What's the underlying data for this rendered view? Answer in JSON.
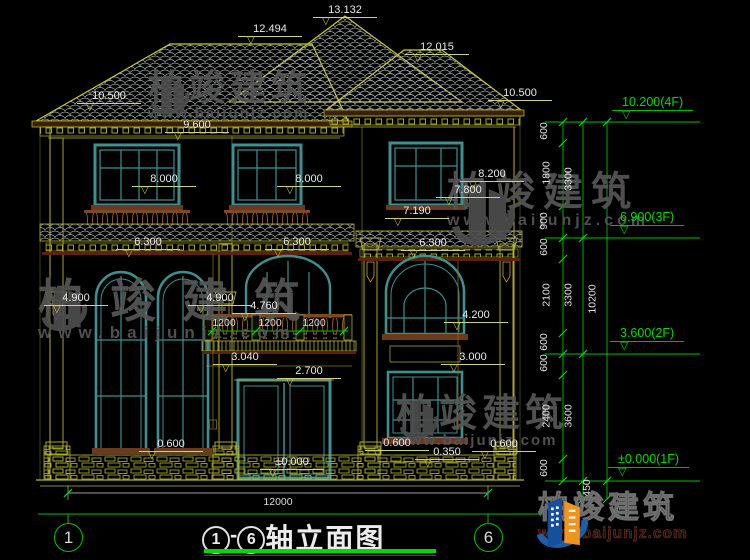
{
  "watermark": {
    "name": "柏竣建筑",
    "url": "www.baijunjz.com"
  },
  "logo": {
    "name": "柏竣建筑",
    "url": "www.baijunjz.com"
  },
  "title": {
    "axis_start": "1",
    "separator": "-",
    "axis_end": "6",
    "text": "轴立面图"
  },
  "axis_bubbles": {
    "left": "1",
    "right": "6"
  },
  "levels": [
    {
      "label": "10.200(4F)",
      "x": 612,
      "y": 96
    },
    {
      "label": "6.900(3F)",
      "x": 610,
      "y": 211
    },
    {
      "label": "3.600(2F)",
      "x": 610,
      "y": 327
    },
    {
      "label": "±0.000(1F)",
      "x": 608,
      "y": 453
    }
  ],
  "dims": [
    {
      "t": "13.132",
      "x": 345,
      "y": 4
    },
    {
      "t": "12.494",
      "x": 270,
      "y": 23
    },
    {
      "t": "12.015",
      "x": 437,
      "y": 41
    },
    {
      "t": "10.500",
      "x": 109,
      "y": 90
    },
    {
      "t": "10.500",
      "x": 520,
      "y": 87
    },
    {
      "t": "9.600",
      "x": 197,
      "y": 119
    },
    {
      "t": "8.000",
      "x": 164,
      "y": 173
    },
    {
      "t": "8.000",
      "x": 309,
      "y": 173
    },
    {
      "t": "8.200",
      "x": 492,
      "y": 168
    },
    {
      "t": "7.800",
      "x": 468,
      "y": 184
    },
    {
      "t": "7.190",
      "x": 417,
      "y": 205
    },
    {
      "t": "6.300",
      "x": 148,
      "y": 236
    },
    {
      "t": "6.300",
      "x": 297,
      "y": 236
    },
    {
      "t": "6.300",
      "x": 433,
      "y": 237
    },
    {
      "t": "4.900",
      "x": 76,
      "y": 292
    },
    {
      "t": "4.900",
      "x": 220,
      "y": 292
    },
    {
      "t": "4.760",
      "x": 264,
      "y": 300
    },
    {
      "t": "3.040",
      "x": 245,
      "y": 351
    },
    {
      "t": "2.700",
      "x": 309,
      "y": 365
    },
    {
      "t": "4.200",
      "x": 476,
      "y": 309
    },
    {
      "t": "3.000",
      "x": 473,
      "y": 351
    },
    {
      "t": "0.600",
      "x": 171,
      "y": 438
    },
    {
      "t": "0.600",
      "x": 397,
      "y": 437
    },
    {
      "t": "0.350",
      "x": 447,
      "y": 446
    },
    {
      "t": "0.600",
      "x": 504,
      "y": 438
    },
    {
      "t": "±0.000",
      "x": 292,
      "y": 456
    }
  ],
  "plains": [
    {
      "t": "1200",
      "x": 224,
      "y": 317
    },
    {
      "t": "1200",
      "x": 270,
      "y": 317
    },
    {
      "t": "1200",
      "x": 314,
      "y": 317
    },
    {
      "t": "12000",
      "x": 278,
      "y": 496
    }
  ],
  "chain": [
    {
      "t": "600",
      "x": 551,
      "y": 132
    },
    {
      "t": "1800",
      "x": 551,
      "y": 174
    },
    {
      "t": "900",
      "x": 551,
      "y": 222
    },
    {
      "t": "600",
      "x": 551,
      "y": 248
    },
    {
      "t": "2100",
      "x": 551,
      "y": 296
    },
    {
      "t": "600",
      "x": 551,
      "y": 343
    },
    {
      "t": "600",
      "x": 551,
      "y": 364
    },
    {
      "t": "2400",
      "x": 551,
      "y": 417
    },
    {
      "t": "600",
      "x": 551,
      "y": 469
    },
    {
      "t": "3300",
      "x": 573,
      "y": 180
    },
    {
      "t": "3300",
      "x": 573,
      "y": 296
    },
    {
      "t": "3600",
      "x": 573,
      "y": 417
    },
    {
      "t": "10200",
      "x": 594,
      "y": 300
    },
    {
      "t": "450",
      "x": 594,
      "y": 489
    }
  ]
}
